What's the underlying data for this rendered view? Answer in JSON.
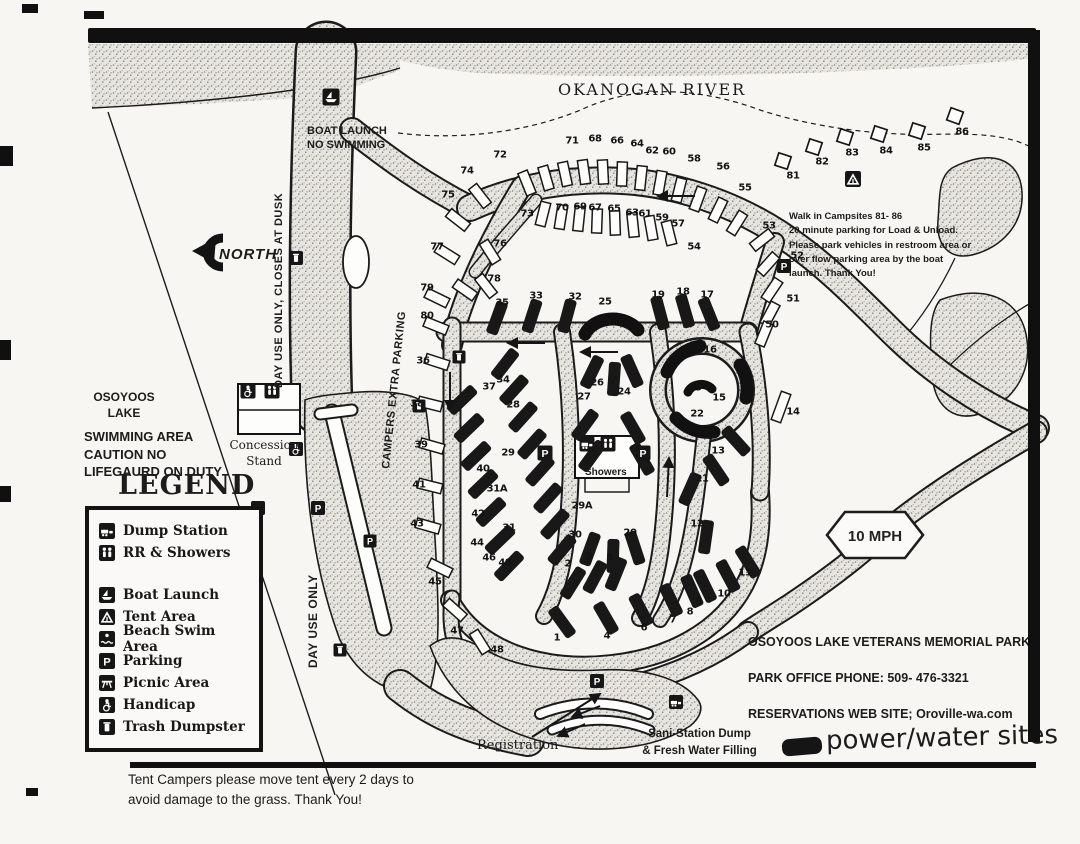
{
  "labels": {
    "river": "OKANOGAN RIVER",
    "boat_launch": "BOAT LAUNCH\nNO SWIMMING",
    "day_use_dusk": "DAY USE ONLY, CLOSES AT DUSK",
    "north": "NORTH",
    "campers_parking": "CAMPERS  EXTRA PARKING",
    "day_use": "DAY USE ONLY",
    "lake_name": "OSOYOOS\nLAKE",
    "swim_warning": "SWIMMING AREA\nCAUTION NO\nLIFEGAURD ON DUTY",
    "concession": "Concession\nStand",
    "showers": "Showers",
    "walkin_note": "Walk in Campsites 81- 86\n20 minute parking for Load & Unload.\nPlease park vehicles in restroom area or\nover flow parking area by the boat\nlaunch. Thank You!",
    "speed": "10 MPH",
    "park_name": "OSOYOOS LAKE  VETERANS MEMORIAL PARK",
    "park_phone": "PARK OFFICE PHONE: 509- 476-3321",
    "park_reservations": "RESERVATIONS WEB SITE;  Oroville-wa.com",
    "sani_station": "Sani-Station Dump\n& Fresh Water Filling",
    "power_water": "power/water sites",
    "registration": "Registration",
    "tent_note": "Tent Campers please move tent every 2 days to\navoid damage to the grass.   Thank You!"
  },
  "legend": {
    "title": "LEGEND",
    "items": [
      {
        "icon": "dump",
        "label": "Dump Station"
      },
      {
        "icon": "restroom",
        "label": "RR & Showers"
      },
      {
        "icon": "boat",
        "label": "Boat Launch"
      },
      {
        "icon": "tent",
        "label": "Tent Area"
      },
      {
        "icon": "beach",
        "label": "Beach Swim Area"
      },
      {
        "icon": "parking",
        "label": "Parking"
      },
      {
        "icon": "picnic",
        "label": "Picnic Area"
      },
      {
        "icon": "handicap",
        "label": "Handicap"
      },
      {
        "icon": "trash",
        "label": "Trash Dumpster"
      }
    ]
  },
  "map": {
    "colors": {
      "ink": "#181818",
      "paper": "#f7f6f3",
      "stipple_bg": "#e7e5e0"
    },
    "icon_glyphs": {
      "parking": "P"
    },
    "sites": [
      [
        "1",
        557,
        638
      ],
      [
        "2",
        568,
        564
      ],
      [
        "3",
        589,
        557
      ],
      [
        "4",
        607,
        636
      ],
      [
        "5",
        610,
        558
      ],
      [
        "6",
        644,
        628
      ],
      [
        "7",
        673,
        620
      ],
      [
        "8",
        690,
        612
      ],
      [
        "9",
        699,
        602
      ],
      [
        "10",
        724,
        594
      ],
      [
        "11",
        745,
        573
      ],
      [
        "12",
        697,
        524
      ],
      [
        "13",
        718,
        451
      ],
      [
        "14",
        793,
        412
      ],
      [
        "15",
        719,
        398
      ],
      [
        "16",
        710,
        350
      ],
      [
        "17",
        707,
        295
      ],
      [
        "18",
        683,
        292
      ],
      [
        "19",
        658,
        295
      ],
      [
        "20",
        630,
        533
      ],
      [
        "21",
        702,
        479
      ],
      [
        "22",
        697,
        414
      ],
      [
        "23",
        695,
        388
      ],
      [
        "24",
        624,
        392
      ],
      [
        "25",
        605,
        302
      ],
      [
        "26",
        597,
        383
      ],
      [
        "27",
        584,
        397
      ],
      [
        "28",
        513,
        405
      ],
      [
        "29",
        508,
        453
      ],
      [
        "29A",
        582,
        506
      ],
      [
        "30",
        575,
        535
      ],
      [
        "31",
        509,
        528
      ],
      [
        "31A",
        497,
        489
      ],
      [
        "32",
        575,
        297
      ],
      [
        "33",
        536,
        296
      ],
      [
        "34",
        503,
        380
      ],
      [
        "35",
        502,
        303
      ],
      [
        "36",
        423,
        361
      ],
      [
        "37",
        489,
        387
      ],
      [
        "38",
        417,
        404
      ],
      [
        "39",
        421,
        445
      ],
      [
        "40",
        483,
        469
      ],
      [
        "41",
        419,
        485
      ],
      [
        "42",
        478,
        514
      ],
      [
        "43",
        417,
        524
      ],
      [
        "44",
        477,
        543
      ],
      [
        "45",
        435,
        582
      ],
      [
        "46",
        489,
        558
      ],
      [
        "47",
        457,
        631
      ],
      [
        "48",
        497,
        650
      ],
      [
        "49",
        505,
        563
      ],
      [
        "50",
        772,
        325
      ],
      [
        "51",
        793,
        299
      ],
      [
        "52",
        797,
        256
      ],
      [
        "53",
        769,
        226
      ],
      [
        "54",
        694,
        247
      ],
      [
        "55",
        745,
        188
      ],
      [
        "56",
        723,
        167
      ],
      [
        "57",
        678,
        224
      ],
      [
        "58",
        694,
        159
      ],
      [
        "59",
        662,
        218
      ],
      [
        "60",
        669,
        152
      ],
      [
        "61",
        645,
        214
      ],
      [
        "62",
        652,
        151
      ],
      [
        "63",
        632,
        213
      ],
      [
        "64",
        637,
        144
      ],
      [
        "65",
        614,
        209
      ],
      [
        "66",
        617,
        141
      ],
      [
        "67",
        595,
        208
      ],
      [
        "68",
        595,
        139
      ],
      [
        "69",
        580,
        207
      ],
      [
        "70",
        562,
        208
      ],
      [
        "71",
        572,
        141
      ],
      [
        "72",
        500,
        155
      ],
      [
        "73",
        527,
        214
      ],
      [
        "74",
        467,
        171
      ],
      [
        "75",
        448,
        195
      ],
      [
        "76",
        500,
        244
      ],
      [
        "77",
        437,
        247
      ],
      [
        "78",
        494,
        279
      ],
      [
        "79",
        427,
        288
      ],
      [
        "80",
        427,
        316
      ],
      [
        "81",
        793,
        176
      ],
      [
        "82",
        822,
        162
      ],
      [
        "83",
        852,
        153
      ],
      [
        "84",
        886,
        151
      ],
      [
        "85",
        924,
        148
      ],
      [
        "86",
        962,
        132
      ]
    ],
    "bars": [
      [
        497,
        318,
        20
      ],
      [
        532,
        316,
        18
      ],
      [
        567,
        316,
        15
      ],
      [
        660,
        313,
        -15
      ],
      [
        685,
        311,
        -16
      ],
      [
        709,
        314,
        -22
      ],
      [
        505,
        364,
        38
      ],
      [
        462,
        400,
        46
      ],
      [
        469,
        428,
        46
      ],
      [
        476,
        456,
        46
      ],
      [
        483,
        484,
        46
      ],
      [
        491,
        512,
        46
      ],
      [
        500,
        540,
        46
      ],
      [
        509,
        566,
        44
      ],
      [
        514,
        390,
        42
      ],
      [
        523,
        417,
        42
      ],
      [
        532,
        444,
        42
      ],
      [
        540,
        471,
        42
      ],
      [
        548,
        498,
        42
      ],
      [
        555,
        524,
        42
      ],
      [
        562,
        550,
        40
      ],
      [
        592,
        372,
        26
      ],
      [
        614,
        379,
        4
      ],
      [
        632,
        371,
        -24
      ],
      [
        585,
        425,
        36
      ],
      [
        592,
        456,
        36
      ],
      [
        633,
        428,
        -30
      ],
      [
        642,
        459,
        -30
      ],
      [
        590,
        549,
        20
      ],
      [
        613,
        556,
        2
      ],
      [
        635,
        548,
        -18
      ],
      [
        736,
        441,
        -42
      ],
      [
        690,
        489,
        24
      ],
      [
        706,
        537,
        8
      ],
      [
        716,
        470,
        -34
      ],
      [
        573,
        583,
        32
      ],
      [
        595,
        577,
        28
      ],
      [
        616,
        574,
        22
      ],
      [
        562,
        622,
        -36
      ],
      [
        606,
        618,
        -30
      ],
      [
        641,
        610,
        -28
      ],
      [
        671,
        600,
        -26
      ],
      [
        692,
        591,
        -24
      ],
      [
        705,
        586,
        -26
      ],
      [
        728,
        576,
        -28
      ],
      [
        748,
        562,
        -32
      ]
    ],
    "spurs": [
      [
        527,
        183,
        -22
      ],
      [
        546,
        178,
        -16
      ],
      [
        565,
        174,
        -12
      ],
      [
        584,
        172,
        -8
      ],
      [
        603,
        172,
        -3
      ],
      [
        622,
        174,
        2
      ],
      [
        641,
        178,
        6
      ],
      [
        660,
        183,
        10
      ],
      [
        679,
        190,
        14
      ],
      [
        698,
        199,
        20
      ],
      [
        718,
        210,
        26
      ],
      [
        737,
        223,
        32
      ],
      [
        543,
        214,
        14
      ],
      [
        561,
        217,
        9
      ],
      [
        579,
        219,
        6
      ],
      [
        597,
        221,
        2
      ],
      [
        615,
        223,
        -2
      ],
      [
        633,
        225,
        -6
      ],
      [
        651,
        228,
        -10
      ],
      [
        669,
        233,
        -14
      ],
      [
        480,
        196,
        -38
      ],
      [
        458,
        220,
        -52
      ],
      [
        447,
        254,
        -58
      ],
      [
        490,
        252,
        -32
      ],
      [
        465,
        290,
        -55
      ],
      [
        486,
        286,
        -38
      ],
      [
        437,
        298,
        -64
      ],
      [
        436,
        326,
        -68
      ],
      [
        437,
        362,
        -72
      ],
      [
        430,
        404,
        -76
      ],
      [
        432,
        446,
        -74
      ],
      [
        430,
        486,
        -76
      ],
      [
        428,
        526,
        -74
      ],
      [
        440,
        568,
        -64
      ],
      [
        455,
        610,
        -48
      ],
      [
        480,
        642,
        -32
      ],
      [
        762,
        240,
        52
      ],
      [
        768,
        264,
        42
      ],
      [
        772,
        290,
        34
      ],
      [
        770,
        314,
        28
      ],
      [
        764,
        334,
        22
      ],
      [
        781,
        407,
        20,
        30
      ]
    ],
    "walkin_squares": [
      [
        783,
        161,
        18
      ],
      [
        814,
        147,
        18
      ],
      [
        845,
        137,
        18
      ],
      [
        879,
        134,
        18
      ],
      [
        917,
        131,
        18
      ],
      [
        955,
        116,
        20
      ]
    ],
    "icons": [
      {
        "t": "boat",
        "x": 331,
        "y": 97,
        "s": 17
      },
      {
        "t": "trash",
        "x": 296,
        "y": 258,
        "s": 14
      },
      {
        "t": "handicap",
        "x": 248,
        "y": 391,
        "s": 15
      },
      {
        "t": "restroom",
        "x": 272,
        "y": 391,
        "s": 15
      },
      {
        "t": "handicap",
        "x": 296,
        "y": 449,
        "s": 14
      },
      {
        "t": "picnic",
        "x": 258,
        "y": 508,
        "s": 14
      },
      {
        "t": "parking",
        "x": 318,
        "y": 508,
        "s": 14
      },
      {
        "t": "parking",
        "x": 370,
        "y": 541,
        "s": 13
      },
      {
        "t": "trash",
        "x": 340,
        "y": 650,
        "s": 13
      },
      {
        "t": "trash",
        "x": 419,
        "y": 406,
        "s": 13
      },
      {
        "t": "trash",
        "x": 459,
        "y": 357,
        "s": 13
      },
      {
        "t": "parking",
        "x": 545,
        "y": 453,
        "s": 15
      },
      {
        "t": "dump",
        "x": 587,
        "y": 444,
        "s": 15
      },
      {
        "t": "restroom",
        "x": 608,
        "y": 444,
        "s": 15
      },
      {
        "t": "parking",
        "x": 643,
        "y": 453,
        "s": 15
      },
      {
        "t": "parking",
        "x": 784,
        "y": 266,
        "s": 14
      },
      {
        "t": "parking",
        "x": 597,
        "y": 681,
        "s": 14
      },
      {
        "t": "dump",
        "x": 676,
        "y": 702,
        "s": 14
      },
      {
        "t": "tent",
        "x": 853,
        "y": 179,
        "s": 16
      }
    ]
  }
}
